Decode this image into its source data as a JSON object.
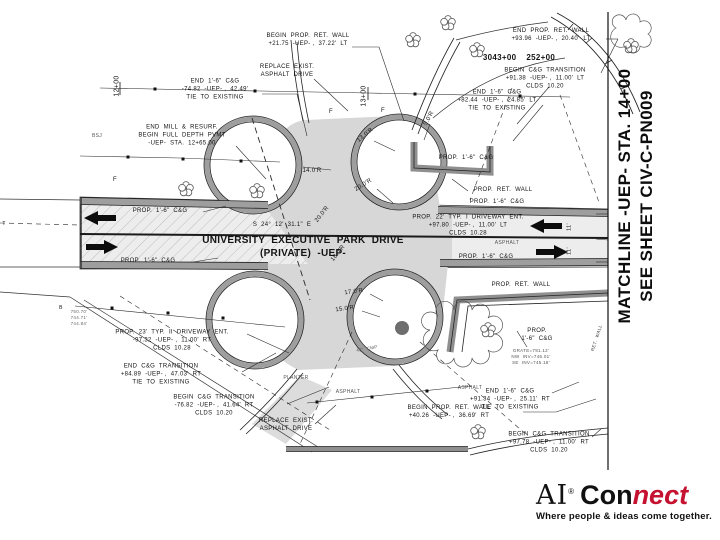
{
  "plan": {
    "matchline": {
      "line1": "MATCHLINE -UEP- STA. 14+00",
      "line2": "SEE SHEET CIV-C-PN009"
    },
    "road": {
      "name_line1": "UNIVERSITY  EXECUTIVE  PARK  DRIVE",
      "name_line2": "(PRIVATE)  -UEP-",
      "bearing": "S  24°  12'  31.1\"  E"
    },
    "labels": [
      {
        "name": "begin-ret-wall-n",
        "text": "BEGIN  PROP.  RET.  WALL\n+21.75  -UEP- ,  37.22'  LT",
        "x": 308,
        "y": 41
      },
      {
        "name": "end-ret-wall-n",
        "text": "END  PROP.  RET.  WALL\n+93.96  -UEP- ,  20.40'  LT",
        "x": 551,
        "y": 36
      },
      {
        "name": "replace-exist-n",
        "text": "REPLACE  EXIST.\nASPHALT  DRIVE",
        "x": 287,
        "y": 72
      },
      {
        "name": "stations-bold",
        "text": "3043+00    252+00",
        "x": 519,
        "y": 58,
        "bold": true,
        "size": 8
      },
      {
        "name": "begin-cg-trans-ne",
        "text": "BEGIN  C&G  TRANSITION\n+91.38  -UEP- ,  11.00'  LT\nCLDS  10.20",
        "x": 545,
        "y": 79
      },
      {
        "name": "end-cg-nw",
        "text": "END  1'-6\"  C&G\n-74.82  -UEP- ,  42.49'\nTIE  TO  EXISTING",
        "x": 215,
        "y": 90
      },
      {
        "name": "end-cg-ne",
        "text": "END  1'-6\"  C&G\n+82.44  -UEP- ,  24.85'  LT\nTIE  TO  EXISTING",
        "x": 497,
        "y": 101
      },
      {
        "name": "station-12",
        "text": "12+00",
        "x": 117,
        "y": 86,
        "rot": -90,
        "size": 7
      },
      {
        "name": "station-13",
        "text": "13+00",
        "x": 364,
        "y": 96,
        "rot": -90,
        "size": 7
      },
      {
        "name": "end-mill-resurf",
        "text": "END  MILL  &  RESURF.\nBEGIN  FULL  DEPTH  PVMT\n-UEP-  STA.  12+65.00",
        "x": 182,
        "y": 136
      },
      {
        "name": "bsj",
        "text": "BSJ",
        "x": 97,
        "y": 136,
        "size": 5,
        "color": "#555555"
      },
      {
        "name": "prop-cg-nw",
        "text": "PROP.  1'-6\"  C&G",
        "x": 160,
        "y": 212
      },
      {
        "name": "bearing",
        "text": "S  24°  12'  31.1\"  E",
        "x": 282,
        "y": 226,
        "size": 6
      },
      {
        "name": "road-name",
        "text": "UNIVERSITY  EXECUTIVE  PARK  DRIVE\n(PRIVATE)  -UEP-",
        "x": 303,
        "y": 247,
        "bold": true,
        "size": 10
      },
      {
        "name": "prop-cg-sw",
        "text": "PROP.  1'-6\"  C&G",
        "x": 148,
        "y": 262
      },
      {
        "name": "radius-13",
        "text": "13.0'R",
        "x": 366,
        "y": 136,
        "rot": -40
      },
      {
        "name": "radius-14",
        "text": "14.0'R",
        "x": 312,
        "y": 172
      },
      {
        "name": "radius-20a",
        "text": "20.0'R",
        "x": 364,
        "y": 186,
        "rot": -32
      },
      {
        "name": "radius-5",
        "text": "5.0'R",
        "x": 430,
        "y": 119,
        "rot": -62
      },
      {
        "name": "radius-20b",
        "text": "20.0'R",
        "x": 323,
        "y": 215,
        "rot": -52
      },
      {
        "name": "radius-18",
        "text": "18.0'R",
        "x": 339,
        "y": 254,
        "rot": -52
      },
      {
        "name": "radius-17",
        "text": "17.0'R",
        "x": 354,
        "y": 293,
        "rot": -8
      },
      {
        "name": "radius-15",
        "text": "15.0'R",
        "x": 345,
        "y": 310,
        "rot": -8
      },
      {
        "name": "prop-cg-ne",
        "text": "PROP.  1'-6\"  C&G",
        "x": 466,
        "y": 159
      },
      {
        "name": "prop-ret-wall-e",
        "text": "PROP.  RET.  WALL",
        "x": 503,
        "y": 191
      },
      {
        "name": "prop-cg-e",
        "text": "PROP.  1'-6\"  C&G",
        "x": 497,
        "y": 203
      },
      {
        "name": "driveway-ent-e",
        "text": "PROP.  22'  TYP.  I  DRIVEWAY  ENT.\n+97.80  -UEP- ,  11.00'  LT\nCLDS  10.28",
        "x": 468,
        "y": 226
      },
      {
        "name": "lane-11-n",
        "text": "11'",
        "x": 570,
        "y": 227,
        "rot": -90,
        "size": 5.5
      },
      {
        "name": "lane-11-s",
        "text": "11'",
        "x": 570,
        "y": 251,
        "rot": -90,
        "size": 5.5
      },
      {
        "name": "asphalt-e",
        "text": "ASPHALT",
        "x": 507,
        "y": 243,
        "size": 5,
        "color": "#555555"
      },
      {
        "name": "prop-cg-e2",
        "text": "PROP.  1'-6\"  C&G",
        "x": 486,
        "y": 258
      },
      {
        "name": "prop-ret-wall-se",
        "text": "PROP.  RET.  WALL",
        "x": 521,
        "y": 286
      },
      {
        "name": "prop-cg-se",
        "text": "PROP.\n1'-6\"  C&G",
        "x": 537,
        "y": 336
      },
      {
        "name": "grate-inverts",
        "text": "GRATE=791.12'\nNW  INV=746.01'\nSE  INV=745.18'",
        "x": 531,
        "y": 357,
        "size": 4.5,
        "color": "#555555"
      },
      {
        "name": "ret-wall-rotated",
        "text": "RET.  WALL",
        "x": 597,
        "y": 338,
        "rot": -72,
        "size": 4.5,
        "color": "#444444"
      },
      {
        "name": "asphalt-se",
        "text": "ASPHALT",
        "x": 470,
        "y": 388,
        "size": 5,
        "color": "#555555"
      },
      {
        "name": "end-cg-se",
        "text": "END  1'-6\"  C&G\n+91.34  -UEP- ,  25.11'  RT\nTIE  TO  EXISTING",
        "x": 510,
        "y": 400
      },
      {
        "name": "begin-cg-trans-se",
        "text": "BEGIN  C&G  TRANSITION\n+97.78  -UEP- ,  11.00'  RT\nCLDS  10.20",
        "x": 549,
        "y": 443
      },
      {
        "name": "driveway-ent-w",
        "text": "PROP.  23'  TYP.  II  DRIVEWAY  ENT.\n-97.32  -UEP- ,  11.00'  RT\nCLDS  10.28",
        "x": 172,
        "y": 341
      },
      {
        "name": "end-cg-trans-sw",
        "text": "END  C&G  TRANSITION\n+84.89  -UEP- ,  47.03'  RT\nTIE  TO  EXISTING",
        "x": 161,
        "y": 375
      },
      {
        "name": "begin-cg-trans-sw",
        "text": "BEGIN  C&G  TRANSITION\n-76.82  -UEP- ,  41.64'  RT\nCLDS  10.20",
        "x": 214,
        "y": 406
      },
      {
        "name": "replace-exist-s",
        "text": "REPLACE  EXIST.\nASPHALT  DRIVE",
        "x": 286,
        "y": 426
      },
      {
        "name": "elev-stack",
        "text": "750.70'\n744.71'\n744.84'",
        "x": 79,
        "y": 318,
        "size": 4.5,
        "color": "#666666"
      },
      {
        "name": "planter",
        "text": "PLANTER",
        "x": 296,
        "y": 378,
        "size": 5,
        "color": "#555555"
      },
      {
        "name": "asphalt-s",
        "text": "ASPHALT",
        "x": 348,
        "y": 392,
        "size": 5,
        "color": "#555555"
      },
      {
        "name": "begin-ret-wall-s",
        "text": "BEGIN  PROP.  RET.  WALL\n+40.26  -UEP- ,  36.69'  RT",
        "x": 449,
        "y": 413
      },
      {
        "name": "cmp-pipe",
        "text": "48\"  CMP",
        "x": 367,
        "y": 349,
        "rot": -10,
        "size": 4.5,
        "color": "#555555"
      },
      {
        "name": "fence-f1",
        "text": "F",
        "x": 115,
        "y": 181,
        "size": 6
      },
      {
        "name": "fence-f2",
        "text": "F",
        "x": 331,
        "y": 113,
        "size": 6
      },
      {
        "name": "fence-f3",
        "text": "F",
        "x": 383,
        "y": 112,
        "size": 6
      },
      {
        "name": "t-left",
        "text": "T",
        "x": 4,
        "y": 224,
        "size": 5
      },
      {
        "name": "b-left",
        "text": "B",
        "x": 61,
        "y": 308,
        "size": 5
      }
    ]
  },
  "logo": {
    "brand_serif": "AI",
    "trademark": "®",
    "word_black": "Con",
    "word_red": "nect",
    "tagline": "Where people & ideas come together.",
    "red_hex": "#c41230"
  },
  "colors": {
    "paper": "#ffffff",
    "ink": "#1a1a1a",
    "asphalt_new": "#d7d7d7",
    "asphalt_exist": "#ededed",
    "curb_gray": "#9e9e9e"
  }
}
